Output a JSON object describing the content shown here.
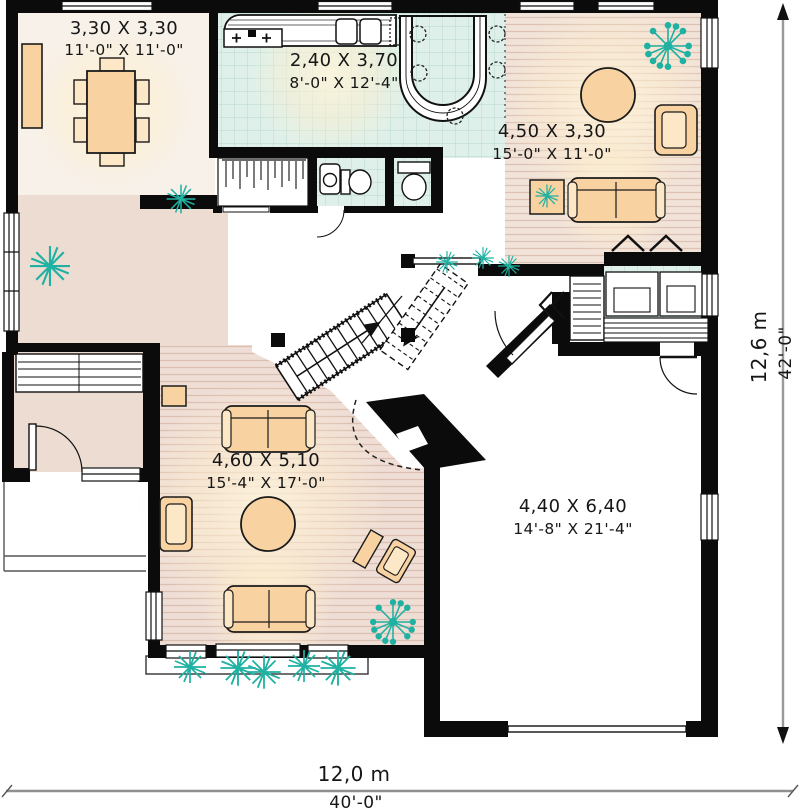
{
  "rooms": {
    "dining": {
      "metric": "3,30 X 3,30",
      "imperial": "11'-0\" X 11'-0\""
    },
    "kitchen": {
      "metric": "2,40 X 3,70",
      "imperial": "8'-0\" X 12'-4\""
    },
    "living": {
      "metric": "4,50 X 3,30",
      "imperial": "15'-0\" X 11'-0\""
    },
    "family": {
      "metric": "4,60 X 5,10",
      "imperial": "15'-4\" X 17'-0\""
    },
    "garage": {
      "metric": "4,40 X 6,40",
      "imperial": "14'-8\" X 21'-4\""
    }
  },
  "dimensions": {
    "overall_width_metric": "12,0 m",
    "overall_width_imperial": "40'-0\"",
    "overall_depth_metric": "12,6 m",
    "overall_depth_imperial": "42'-0\""
  },
  "icons": {
    "plant": "teal radial burst",
    "plant_dotted": "teal burst with dot tips",
    "stair_arrow": "direction arrow",
    "stove_burner": "plus glyph"
  },
  "colors": {
    "wall": "#0b0b0b",
    "tile_floor": "#dff0ea",
    "wood_floor": "#f2e3d9",
    "family_floor": "#efded6",
    "hall_floor": "#ecdcd2",
    "dining_floor": "#f7f1ea",
    "furniture": "#f8d2a0",
    "furniture_light": "#fce7c6",
    "plant": "#1fb1a2",
    "glow": "#fff5dc",
    "dimension_line": "#9a9a9a"
  }
}
